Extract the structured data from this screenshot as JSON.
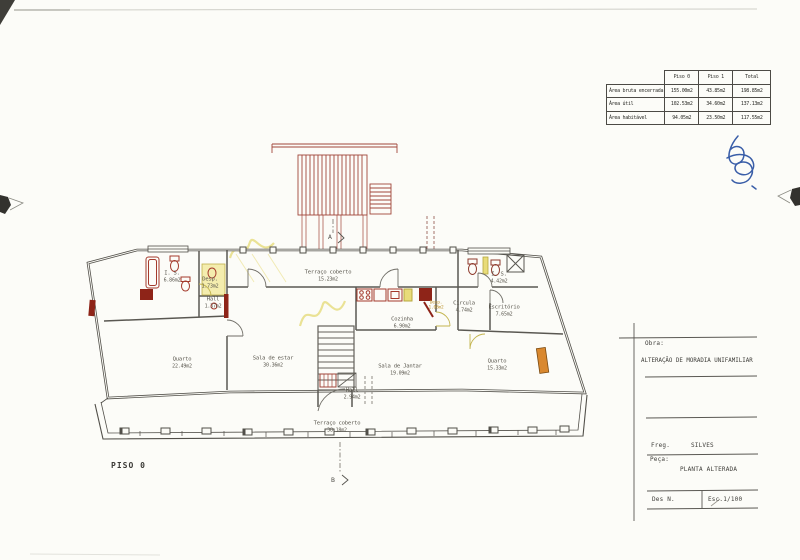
{
  "drawing": {
    "floor_label": "PISO 0",
    "section_marker_a": "A",
    "section_marker_b": "B",
    "rooms": {
      "is_left": {
        "name": "I. S.",
        "area": "6.86m2"
      },
      "desp_left": {
        "name": "Desp.",
        "area": "1.73m2"
      },
      "hall_left": {
        "name": "Hall",
        "area": "1.37m2"
      },
      "quarto_left": {
        "name": "Quarto",
        "area": "22.49m2"
      },
      "sala_estar": {
        "name": "Sala de estar",
        "area": "30.36m2"
      },
      "terraco_top": {
        "name": "Terraço coberto",
        "area": "15.23m2"
      },
      "cozinha": {
        "name": "Cozinha",
        "area": "6.90m2"
      },
      "desp_kitchen": {
        "name": "Desp.",
        "area": "1.08m2"
      },
      "sala_jantar": {
        "name": "Sala de Jantar",
        "area": "19.09m2"
      },
      "circulacao": {
        "name": "Circula",
        "area": "4.74m2"
      },
      "escritorio": {
        "name": "Escritório",
        "area": "7.65m2"
      },
      "is_right": {
        "name": "I. S.",
        "area": "4.42m2"
      },
      "quarto_right": {
        "name": "Quarto",
        "area": "15.33m2"
      },
      "hall_bottom": {
        "name": "Hall",
        "area": "2.94m2"
      },
      "terraco_bottom": {
        "name": "Terraço coberto",
        "area": "38.18m2"
      }
    }
  },
  "area_table": {
    "columns": [
      "Piso 0",
      "Piso 1",
      "Total"
    ],
    "rows": [
      {
        "label": "Área bruta encerrada",
        "piso0": "155.00m2",
        "piso1": "43.85m2",
        "total": "198.85m2"
      },
      {
        "label": "Área útil",
        "piso0": "102.53m2",
        "piso1": "34.60m2",
        "total": "137.13m2"
      },
      {
        "label": "Área habitável",
        "piso0": "94.05m2",
        "piso1": "23.50m2",
        "total": "117.55m2"
      }
    ]
  },
  "title_block": {
    "obra_label": "Obra:",
    "obra_value": "ALTERAÇÃO DE MORADIA UNIFAMILIAR",
    "freg_label": "Freg.",
    "freg_value": "SILVES",
    "peca_label": "Peça:",
    "peca_value": "PLANTA ALTERADA",
    "des_label": "Des N.",
    "esc_value": "Esc.1/100"
  },
  "colors": {
    "alteration_red": "#9c2f1f",
    "demolition_yellow": "#e3d878",
    "signature_blue": "#3a5ea8",
    "window_orange": "#d9882f"
  }
}
